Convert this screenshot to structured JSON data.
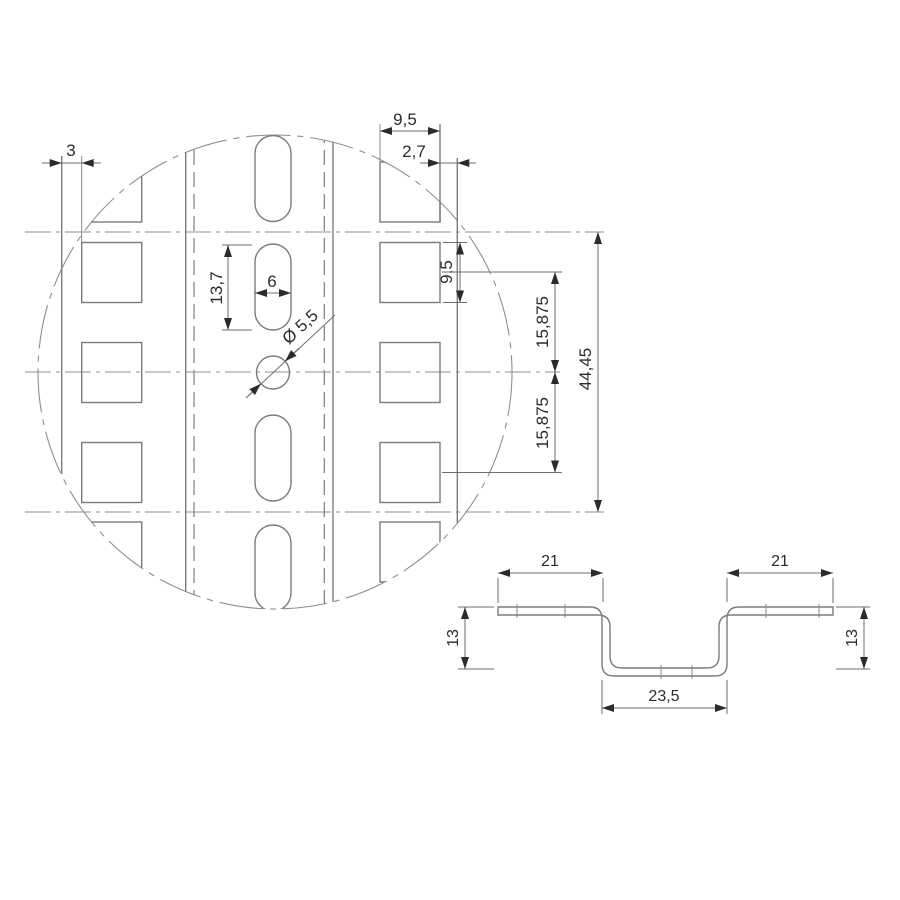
{
  "page": {
    "background": "#ffffff",
    "geometry_line_color": "#7c7c7c",
    "dimension_line_color": "#6e6e6e",
    "text_color": "#2b2b2b"
  },
  "detail_view": {
    "dim_edge_margin": "3",
    "dim_square_width_top": "9,5",
    "dim_edge_offset": "2,7",
    "dim_slot_length": "13,7",
    "dim_slot_width": "6",
    "dim_square_height": "9,5",
    "dim_hole_diameter": "Ø 5,5",
    "dim_row_pitch_upper": "15,875",
    "dim_row_pitch_lower": "15,875",
    "dim_total_span": "44,45"
  },
  "section_view": {
    "dim_flange_left": "21",
    "dim_flange_right": "21",
    "dim_depth_left": "13",
    "dim_depth_right": "13",
    "dim_channel_width": "23,5"
  }
}
